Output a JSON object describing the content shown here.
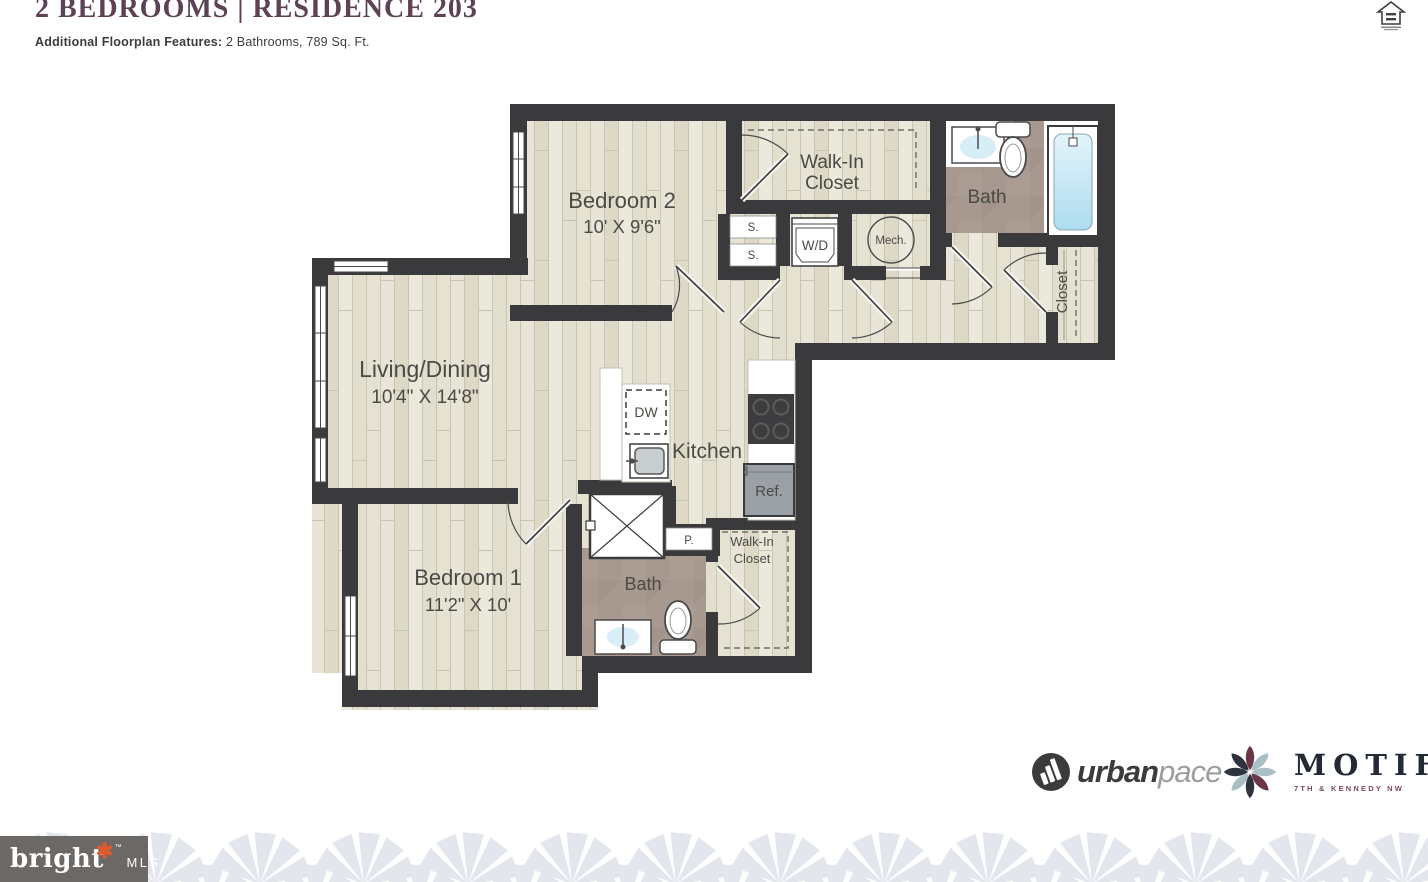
{
  "header": {
    "title": "2 BEDROOMS | RESIDENCE 203",
    "features_label": "Additional Floorplan Features:",
    "features_value": "2 Bathrooms, 789 Sq. Ft."
  },
  "plan": {
    "bedroom2": {
      "name": "Bedroom 2",
      "dims": "10' X 9'6\""
    },
    "walkin_top": {
      "line1": "Walk-In",
      "line2": "Closet"
    },
    "bath_top": {
      "name": "Bath"
    },
    "closet_right": {
      "name": "Closet"
    },
    "living": {
      "name": "Living/Dining",
      "dims": "10'4\" X 14'8\""
    },
    "kitchen": {
      "name": "Kitchen"
    },
    "bedroom1": {
      "name": "Bedroom 1",
      "dims": "11'2\" X 10'"
    },
    "bath_bottom": {
      "name": "Bath"
    },
    "walkin_bottom": {
      "line1": "Walk-In",
      "line2": "Closet"
    },
    "labels": {
      "s1": "S.",
      "s2": "S.",
      "wd": "W/D",
      "mech": "Mech.",
      "dw": "DW",
      "ref": "Ref.",
      "p": "P."
    }
  },
  "footer": {
    "urbanpace": {
      "part1": "urban",
      "part2": "pace"
    },
    "motif": {
      "name": "MOTIF",
      "tagline": "7TH & KENNEDY NW"
    },
    "bright": {
      "name": "bright",
      "tm": "™",
      "suffix": "MLS"
    }
  },
  "colors": {
    "title": "#5d4154",
    "wall": "#3a3a3c",
    "wood": "#e6e3d4",
    "bath_floor": "#a79890",
    "motif_maroon": "#6a3648",
    "motif_steel": "#a9bfc6",
    "motif_dark": "#2e333d",
    "bright_bg": "#6b6865",
    "bright_star": "#dd5b2d"
  }
}
